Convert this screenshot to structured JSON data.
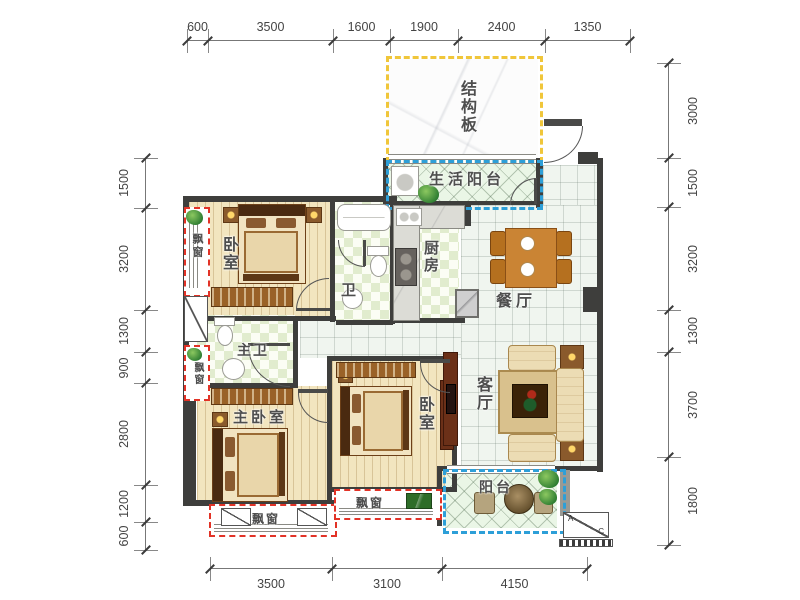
{
  "plan_title": "three-bedroom apartment floor plan",
  "rooms": {
    "structural_slab": "结构板",
    "service_balcony": "生活阳台",
    "bedroom_top": "卧室",
    "bath": "卫",
    "master_bath": "主卫",
    "kitchen": "厨房",
    "dining": "餐厅",
    "living": "客厅",
    "master_bedroom": "主卧室",
    "bedroom_mid": "卧室",
    "balcony": "阳台",
    "bay_left_top": "飘窗",
    "bay_left_mid": "飘窗",
    "bay_bottom_left": "飘窗",
    "bay_bottom_mid": "飘窗"
  },
  "ac_symbol": {
    "a": "A",
    "c": "C"
  },
  "dimensions": {
    "top": [
      "600",
      "3500",
      "1600",
      "1900",
      "2400",
      "1350"
    ],
    "bottom": [
      "3500",
      "3100",
      "4150"
    ],
    "left": [
      "1500",
      "3200",
      "1300",
      "900",
      "2800",
      "1200",
      "600"
    ],
    "right": [
      "3000",
      "1500",
      "3200",
      "1300",
      "3700",
      "1800"
    ]
  },
  "colors": {
    "wall": "#3e3e3c",
    "bay_outline": "#e23327",
    "balcony_outline": "#2d9fd8",
    "slab_outline": "#f0c63a",
    "wood_floor": "#f2e5bf",
    "tile_floor": "#f0f5ef",
    "dimension_text": "#444444"
  }
}
